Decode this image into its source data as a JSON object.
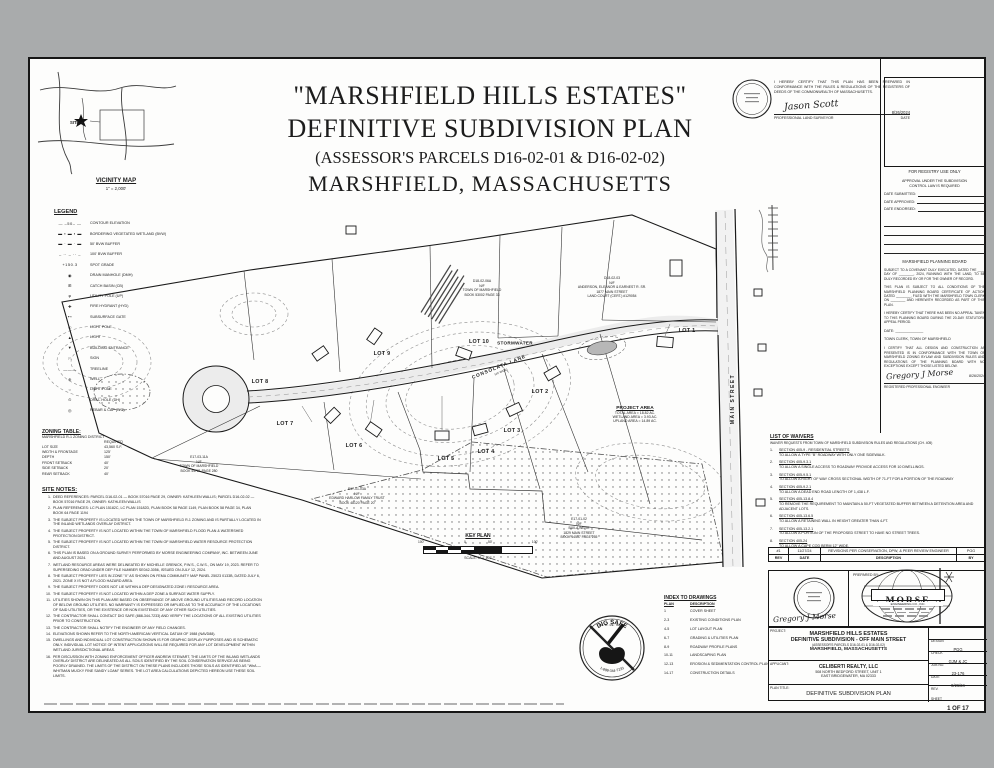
{
  "colors": {
    "page_bg": "#a9abac",
    "sheet": "#fdfdfc",
    "ink": "#1c1c1c",
    "road_fill": "#ececec",
    "basin_gray": "#b7b7b7"
  },
  "header": {
    "line1": "\"MARSHFIELD HILLS ESTATES\"",
    "line2": "DEFINITIVE SUBDIVISION PLAN",
    "line3": "(ASSESSOR'S PARCELS D16-02-01 & D16-02-02)",
    "line4": "MARSHFIELD, MASSACHUSETTS"
  },
  "vicinity": {
    "title": "VICINITY MAP",
    "scale": "1\" = 2,000'",
    "site": "SITE ★"
  },
  "surveyor": {
    "cert": "I HEREBY CERTIFY THAT THIS PLAN HAS BEEN PREPARED IN CONFORMANCE WITH THE RULES & REGULATIONS OF THE REGISTERS OF DEEDS OF THE COMMONWEALTH OF MASSACHUSETTS.",
    "signature": "Jason Scott",
    "role": "PROFESSIONAL LAND SURVEYOR",
    "date_label": "DATE",
    "date": "8/26/2024"
  },
  "registry": {
    "box_label": "FOR REGISTRY USE ONLY",
    "approval1": "APPROVAL UNDER THE SUBDIVISION",
    "approval2": "CONTROL LAW IS REQUIRED",
    "date_submitted": "DATE SUBMITTED:",
    "date_approved": "DATE APPROVED:",
    "date_endorsed": "DATE ENDORSED:"
  },
  "planning": {
    "board": "MARSHFIELD PLANNING BOARD",
    "covenant": "SUBJECT TO A COVENANT DULY EXECUTED, DATED THE ____ DAY OF ________, 2024, RUNNING WITH THE LAND, TO BE DULY RECORDED BY OR FOR THE OWNER OF RECORD.",
    "conditions": "THIS PLAN IS SUBJECT TO ALL CONDITIONS OF THE MARSHFIELD PLANNING BOARD CERTIFICATE OF ACTION DATED ________, FILED WITH THE MARSHFIELD TOWN CLERK ON ________ AND HEREWITH RECORDED AS PART OF THIS PLAN.",
    "no_appeal": "I HEREBY CERTIFY THAT THERE HAS BEEN NO APPEAL TAKEN TO THIS PLANNING BOARD DURING THE 20-DAY STATUTORY APPEAL PERIOD.",
    "date_line": "DATE: ______________",
    "clerk": "TOWN CLERK, TOWN OF MARSHFIELD"
  },
  "engineer": {
    "cert": "I CERTIFY THAT ALL DESIGN AND CONSTRUCTION AS PRESENTED IS IN CONFORMANCE WITH THE TOWN OF MARSHFIELD ZONING BYLAW AND SUBDIVISION RULES AND REGULATIONS OF THE PLANNING BOARD WITH NO EXCEPTIONS EXCEPT THOSE LISTED BELOW.",
    "signature": "Gregory J Morse",
    "role": "REGISTERED PROFESSIONAL ENGINEER",
    "date": "8/26/2024"
  },
  "waivers": {
    "title": "LIST OF WAIVERS",
    "subtitle": "WAIVER REQUESTS FROM TOWN OF MARSHFIELD SUBDIVISION RULES AND REGULATIONS (CH. 405)",
    "items": [
      {
        "num": "1.",
        "section": "SECTION 405-9 - RESIDENTIAL STREETS",
        "text": "TO ALLOW A TYPE \"B\" ROADWAY WITH ONLY ONE SIDEWALK."
      },
      {
        "num": "2.",
        "section": "SECTION 405-9.3.1",
        "text": "TO ALLOW A SINGLE ACCESS TO ROADWAY PROVIDE ACCESS FOR 10 DWELLINGS."
      },
      {
        "num": "3.",
        "section": "SECTION 405-9.5.1",
        "text": "TO ALLOW A RIGHT OF WAY CROSS SECTIONAL WIDTH OF 71-FT FOR A PORTION OF THE ROADWAY"
      },
      {
        "num": "4.",
        "section": "SECTION 405-9.2.1",
        "text": "TO ALLOW A DEAD END ROAD LENGTH OF 1,438 L.F."
      },
      {
        "num": "5.",
        "section": "SECTION 405-13.8.4",
        "text": "TO REMOVE THE REQUIREMENT TO MAINTAIN A 50-FT VEGETATED BUFFER BETWEEN A DETENTION AREA AND ADJACENT LOTS."
      },
      {
        "num": "6.",
        "section": "SECTION 405-13.6.5",
        "text": "TO ALLOW A RETAINING WALL IN HEIGHT GREATER THAN 4-FT."
      },
      {
        "num": "7.",
        "section": "SECTION 405-13.2.1",
        "text": "TO ALLOW A PORTION OF THE PROPOSED STREET TO HAVE NO STREET TREES."
      },
      {
        "num": "8.",
        "section": "SECTION 405-24",
        "text": "TO ALLOW A CAPE COD BERM 12\" WIDE."
      }
    ]
  },
  "revisions": {
    "headers": [
      "REV",
      "DATE",
      "DESCRIPTION",
      "BY"
    ],
    "rows": [
      {
        "rev": "#1",
        "date": "11/27/24",
        "desc": "REVISIONS PER CONSERVATION, DPW, & PEER REVIEW ENGINEER",
        "by": "PGG"
      }
    ]
  },
  "prepared": {
    "label": "PREPARED BY:",
    "firm": "MORSE",
    "firm2": "ENGINEERING CO., INC.",
    "signature": "Gregory J Morse"
  },
  "titleblock": {
    "project_label": "PROJECT:",
    "project_lines": [
      "MARSHFIELD HILLS ESTATES",
      "DEFINITIVE SUBDIVISION - OFF MAIN STREET",
      "(ASSESSOR'S PARCELS D16-02-01 & D16-02-02)",
      "MARSHFIELD, MASSACHUSETTS"
    ],
    "applicant_label": "APPLICANT:",
    "applicant_lines": [
      "CELIBERTI REALTY, LLC",
      "508 NORTH BEDFORD STREET, UNIT 1",
      "EAST BRIDGEWATER, MA 02333"
    ],
    "plan_title_label": "PLAN TITLE:",
    "plan_title": "DEFINITIVE SUBDIVISION PLAN",
    "meta": [
      {
        "label": "DESIGN",
        "value": "PGG"
      },
      {
        "label": "CHECK",
        "value": "GJM & JC"
      },
      {
        "label": "JOB NO.",
        "value": "23-176"
      },
      {
        "label": "DATE",
        "value": "8/26/24"
      },
      {
        "label": "REV.",
        "value": ""
      },
      {
        "label": "SHEET",
        "value": "1 OF 17"
      }
    ]
  },
  "legend": {
    "title": "LEGEND",
    "items": [
      {
        "glyph": "— –50– —",
        "label": "CONTOUR ELEVATION"
      },
      {
        "glyph": "▬ ▪ ▬ ▪ ▬",
        "label": "BORDERING VEGETATED WETLAND (BVW)"
      },
      {
        "glyph": "▬ · ▬ · ▬",
        "label": "50' BVW BUFFER"
      },
      {
        "glyph": "– ·· – ·· –",
        "label": "100' BVW BUFFER"
      },
      {
        "glyph": "+150.3",
        "label": "SPOT GRADE"
      },
      {
        "glyph": "◉",
        "label": "DRAIN MANHOLE (DMH)"
      },
      {
        "glyph": "⊞",
        "label": "CATCH BASIN (CB)"
      },
      {
        "glyph": "φ",
        "label": "UTILITY POLE (UP)"
      },
      {
        "glyph": "✚",
        "label": "FIRE HYDRANT (HYD)"
      },
      {
        "glyph": "⊷",
        "label": "SUBSURFACE GATE"
      },
      {
        "glyph": "☉",
        "label": "LIGHT POLE"
      },
      {
        "glyph": "▲",
        "label": "LIGHT"
      },
      {
        "glyph": "▼",
        "label": "BUILDING ENTRANCE"
      },
      {
        "glyph": "⚐",
        "label": "SIGN"
      },
      {
        "glyph": "﹏﹏﹏",
        "label": "TREELINE"
      },
      {
        "glyph": "⊕",
        "label": "WELL"
      },
      {
        "glyph": "○",
        "label": "LIGHT POLE"
      },
      {
        "glyph": "⊙",
        "label": "DRILL HOLE (DH)"
      },
      {
        "glyph": "◎",
        "label": "REBAR & CAP (R/C)"
      }
    ]
  },
  "zoning": {
    "title": "ZONING TABLE:",
    "district": "MARSHFIELD R-1 ZONING DISTRICT",
    "col": "REQUIRED",
    "rows": [
      {
        "l": "LOT SIZE",
        "v": "43,560 S.F."
      },
      {
        "l": "WIDTH & FRONTAGE",
        "v": "125'"
      },
      {
        "l": "DEPTH",
        "v": "150'"
      },
      {
        "l": "FRONT SETBACK",
        "v": "40'"
      },
      {
        "l": "SIDE SETBACK",
        "v": "20'"
      },
      {
        "l": "REAR SETBACK",
        "v": "40'"
      }
    ]
  },
  "site_notes": {
    "title": "SITE NOTES:",
    "notes": [
      {
        "n": "1.",
        "text": "DEED REFERENCES:  PARCEL D16-02-01 — BOOK 57016 PAGE 29, OWNER: KATHLEEN WALLIS; PARCEL D16-02-02 — BOOK 57016 PAGE 29, OWNER: KATHLEEN WALLIS"
      },
      {
        "n": "2.",
        "text": "PLAN REFERENCES:  LC PLAN 15182C, LC PLAN 15182D, PLAN BOOK 58 PAGE 1149, PLAN BOOK 58 PAGE 34, PLAN BOOK 64 PAGE 1194"
      },
      {
        "n": "3.",
        "text": "THE SUBJECT PROPERTY IS LOCATED WITHIN THE TOWN OF MARSHFIELD R-1 ZONING AND IS PARTIALLY LOCATED IN THE INLAND WETLANDS OVERLAY DISTRICT."
      },
      {
        "n": "4.",
        "text": "THE SUBJECT PROPERTY IS NOT LOCATED WITHIN THE TOWN OF MARSHFIELD FLOOD PLAN & WATERSHED PROTECTION DISTRICT."
      },
      {
        "n": "5.",
        "text": "THE SUBJECT PROPERTY IS NOT LOCATED WITHIN THE TOWN OF MARSHFIELD WATER RESOURCE PROTECTION DISTRICT."
      },
      {
        "n": "6.",
        "text": "THIS PLAN IS BASED ON A GROUND SURVEY PERFORMED BY MORSE ENGINEERING COMPANY, INC. BETWEEN JUNE AND AUGUST 2024."
      },
      {
        "n": "7.",
        "text": "WETLAND RESOURCE AREAS WERE DELINEATED BY MICHELLE GRENICK, P.W.S., C.W.S., ON MAY 19, 2023.  REFER TO SUPERSEDING ORAD UNDER DEP FILE NUMBER SE042-3056, ISSUED ON JULY 12, 2024."
      },
      {
        "n": "8.",
        "text": "THE SUBJECT PROPERTY LIES IN ZONE \"X\" AS SHOWN ON FEMA COMMUNITY MAP PANEL 25023 0133B, DATED JULY 6, 2021.  ZONE X IS NOT A FLOOD HAZARD AREA."
      },
      {
        "n": "9.",
        "text": "THE SUBJECT PROPERTY DOES NOT LIE WITHIN A DEP DESIGNATED ZONE I RESOURCE AREA."
      },
      {
        "n": "10.",
        "text": "THE SUBJECT PROPERTY IS NOT LOCATED WITHIN A DEP ZONE A SURFACE WATER SUPPLY."
      },
      {
        "n": "11.",
        "text": "UTILITIES SHOWN ON THIS PLAN ARE BASED ON OBSERVANCE OF ABOVE GROUND UTILITIES AND RECORD LOCATION OF BELOW GROUND UTILITIES. NO WARRANTY IS EXPRESSED OR IMPLIED AS TO THE ACCURACY OF THE LOCATIONS OF SAID UTILITIES, OR THE EXISTENCE OR NON EXISTENCE OF ANY OTHER SUCH UTILITIES."
      },
      {
        "n": "12.",
        "text": "THE CONTRACTOR SHALL CONTACT DIG SAFE (888-344-7233) AND VERIFY THE LOCATIONS OF ALL EXISTING UTILITIES PRIOR TO CONSTRUCTION."
      },
      {
        "n": "13.",
        "text": "THE CONTRACTOR SHALL NOTIFY THE ENGINEER OF ANY FIELD CHANGES."
      },
      {
        "n": "14.",
        "text": "ELEVATIONS SHOWN REFER TO THE NORTH AMERICAN VERTICAL DATUM OF 1988 (NAVD88)."
      },
      {
        "n": "15.",
        "text": "DWELLINGS AND INDIVIDUAL LOT CONSTRUCTION SHOWN IS FOR GRAPHIC DISPLAY PURPOSES AND IS SCHEMATIC ONLY. INDIVIDUAL LOT NOTICE OF INTENT APPLICATIONS WILL BE REQUIRED FOR ANY LOT DEVELOPMENT WITHIN WETLAND JURISDICTIONAL AREAS."
      },
      {
        "n": "16.",
        "text": "PER DISCUSSION WITH ZONING ENFORCEMENT OFFICER ANDREW STEWART, THE LIMITS OF THE INLAND WETLANDS OVERLAY DISTRICT ARE DELINEATED AS ALL SOILS IDENTIFIED BY THE SOIL CONSERVATION SERVICE AS BEING POORLY DRAINED. THE LIMITS OF THE DISTRICT ON THESE PLANS INCLUDES THOSE SOILS AS IDENTIFIED AS \"WhA — WHITMAN MUCKY FINE SANDY LOAM\" SERIES. THE LOT AREA CALCULATIONS DEPICTED HEREON USE THESE SOIL LIMITS."
      }
    ]
  },
  "plan": {
    "road_label": "CONSOLATA LANE",
    "road_sub": "(40' WIDE)",
    "main_street": "MAIN STREET",
    "stormwater": "STORMWATER",
    "lots": [
      "LOT 1",
      "LOT 2",
      "LOT 3",
      "LOT 4",
      "LOT 5",
      "LOT 6",
      "LOT 7",
      "LOT 8",
      "LOT 9",
      "LOT 10"
    ],
    "project_area": {
      "title": "PROJECT AREA",
      "l1": "TOTAL AREA = 18.82 AC.",
      "l2": "WETLAND AREA = 3.93 AC.",
      "l3": "UPLAND AREA = 14.89 AC."
    },
    "abutters": [
      {
        "lines": [
          "D18-02-06A",
          "N/F",
          "TOWN OF MARSHFIELD",
          "BOOK 53002 PAGE 33"
        ]
      },
      {
        "lines": [
          "D18-02-03",
          "N/F",
          "ANDERSON, ELEANOR & EARNEST R. SR.",
          "1877 MAIN STREET",
          "LAND COURT (CERT.) #129054"
        ]
      },
      {
        "lines": [
          "E17-03-11A",
          "N/F",
          "TOWN OF MARSHFIELD",
          "BOOK 44721 PAGE 280"
        ]
      },
      {
        "lines": [
          "E17-01-03A",
          "N/F",
          "EDWARD HARLOW FAMILY TRUST",
          "BOOK 48120 PAGE 20"
        ]
      },
      {
        "lines": [
          "E17-01-02",
          "N/F",
          "BUILA WEHR",
          "1829 MAIN STREET",
          "BOOK 44557 PAGE 255"
        ]
      }
    ]
  },
  "keyplan": {
    "title": "KEY PLAN",
    "scale": "SCALE: 1\" = 100'",
    "ticks": [
      "100'",
      "0",
      "50'",
      "100'"
    ]
  },
  "digsafe": {
    "name": "DIG SAFE",
    "phone": "1-888-344-7233",
    "states": "MA · RI · ME · NH · VT"
  },
  "index": {
    "title": "INDEX TO DRAWINGS",
    "col1": "PLAN",
    "col2": "DESCRIPTION",
    "rows": [
      {
        "p": "1",
        "d": "COVER SHEET"
      },
      {
        "p": "2-3",
        "d": "EXISTING CONDITIONS PLAN"
      },
      {
        "p": "4-5",
        "d": "LOT LAYOUT PLAN"
      },
      {
        "p": "6-7",
        "d": "GRADING & UTILITIES PLAN"
      },
      {
        "p": "8-9",
        "d": "ROADWAY PROFILE PLANS"
      },
      {
        "p": "10-11",
        "d": "LANDSCAPING PLAN"
      },
      {
        "p": "12-13",
        "d": "EROSION & SEDIMENTATION CONTROL PLAN"
      },
      {
        "p": "14-17",
        "d": "CONSTRUCTION DETAILS"
      }
    ]
  }
}
